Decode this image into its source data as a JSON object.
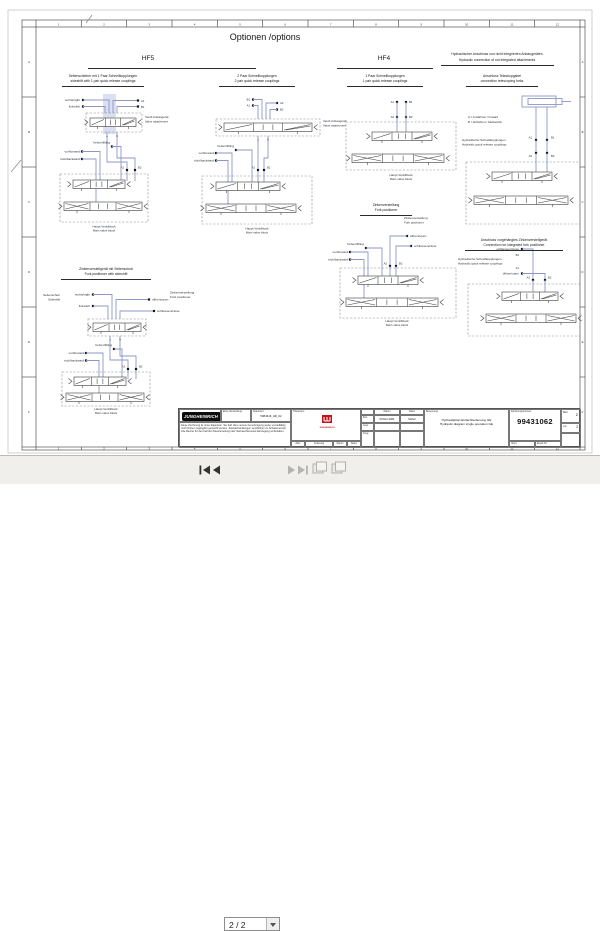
{
  "colors": {
    "schematic_line": "#8e96c6",
    "highlight": "#bcc6e8",
    "brand_red": "#c2151b",
    "logo_bg": "#0c0c0c"
  },
  "viewer": {
    "page_indicator": "2 / 2"
  },
  "sheet": {
    "title": "Optionen /options",
    "frame": {
      "columns": [
        "1",
        "2",
        "3",
        "4",
        "5",
        "6",
        "7",
        "8",
        "9",
        "10",
        "11",
        "12"
      ],
      "rows": [
        "A",
        "B",
        "C",
        "D",
        "E",
        "F"
      ]
    },
    "headings": {
      "hf5": "HF5",
      "hf4": "HF4",
      "hyd_conn_de": "Hydraulischer Anschluss von nicht integrierten Anbaugeräten",
      "hyd_conn_en": "Hydraulic connection of not integrated attachments",
      "sideshift_de": "Seitenschieber mit 1 Paar Schnellkupplungen",
      "sideshift_en": "sideshift with 1 pair quick release couplings",
      "two_pair_de": "2 Paar Schnellkupplungen",
      "two_pair_en": "2 pair quick release couplings",
      "one_pair_de": "1 Paar Schnellkupplungen",
      "one_pair_en": "1 pair quick release couplings",
      "telescopic_de": "Anschluss Teleskopgabel",
      "telescopic_en": "connection telescoping forks",
      "forkpos_side_de": "Zinkenverstellgerät mit Seitenschub",
      "forkpos_side_en": "Fork positioner with sideshift",
      "forkpos_de": "Zinkenverstellung",
      "forkpos_en": "Fork positioner",
      "ext_forkpos_de": "Anschluss vorgehängtes Zinkenverstellgerät",
      "ext_forkpos_en": "Connection not integrated fork positioner"
    },
    "labels": {
      "right": "rechts/right",
      "left": "links/left",
      "open": "öffnen/open",
      "close": "schliessen/close",
      "lift": "heben/lifting",
      "forward": "vor/forward",
      "backward": "rück/backward",
      "valve_attach_de": "Ventil Anbaugerät",
      "valve_attach_en": "Valve attachment",
      "main_de": "Haupt Ventilblock",
      "main_en": "Main valve block",
      "sideshift_de": "Seitenschub",
      "sideshift_en": "Sideshift",
      "forkpos_de": "Zinkenverstellung",
      "forkpos_en": "Fork positioner",
      "quick_de": "Hydraulische Schnellkupplungen",
      "quick_en": "Hydraulic quick release couplings",
      "a_forward": "A = Ausfahren / forward",
      "b_backward": "B = Einfahren / backwards",
      "A": "A",
      "B": "B",
      "A1": "A1",
      "B1": "B1",
      "A2": "A2",
      "B2": "B2"
    },
    "titleblock": {
      "logo": "JUNGHEINRICH",
      "disclaimer": "Diese Zeichnung ist unser Eigentum. Sie darf ohne unsere Genehmigung weder vervielfältigt noch Dritten zugänglich gemacht werden. Zuwiderhandlungen verpflichten zu Schadenersatz. Alle Rechte für den Fall der Patenterteilung oder Gebrauchsmuster-Eintragung vorbehalten.",
      "first_use_label": "Erste Verwendung",
      "document_label": "Dokument",
      "document_value": "5984316_HD_02",
      "tolerance_label": "Toleranzen",
      "brand_mark": "JUNGHEINRICH",
      "rev_row": {
        "zust": "Zust.",
        "aenderung": "Änderung",
        "datum": "Datum",
        "name": "Name"
      },
      "sign_rows": {
        "datum_header": "Datum",
        "name_header": "Name",
        "erst": "Erst.",
        "gepr": "Gepr.",
        "freig": "Freig.",
        "erst_datum": "06.Dez.2004",
        "erst_name": "Stuber"
      },
      "benennung_label": "Benennung",
      "benennung_de": "Hydraulikplan Einfachbedienung GE",
      "benennung_en": "Hydraulic diagram single operation GE",
      "drawing_no_label": "Zeichnungsnummer",
      "drawing_no": "99431062",
      "blatt_label": "Blatt",
      "blatt_value": "2",
      "von_label": "von",
      "von_value": "2",
      "urspr_label": "Urspr.",
      "ersatz_label": "Ersatz für"
    }
  }
}
